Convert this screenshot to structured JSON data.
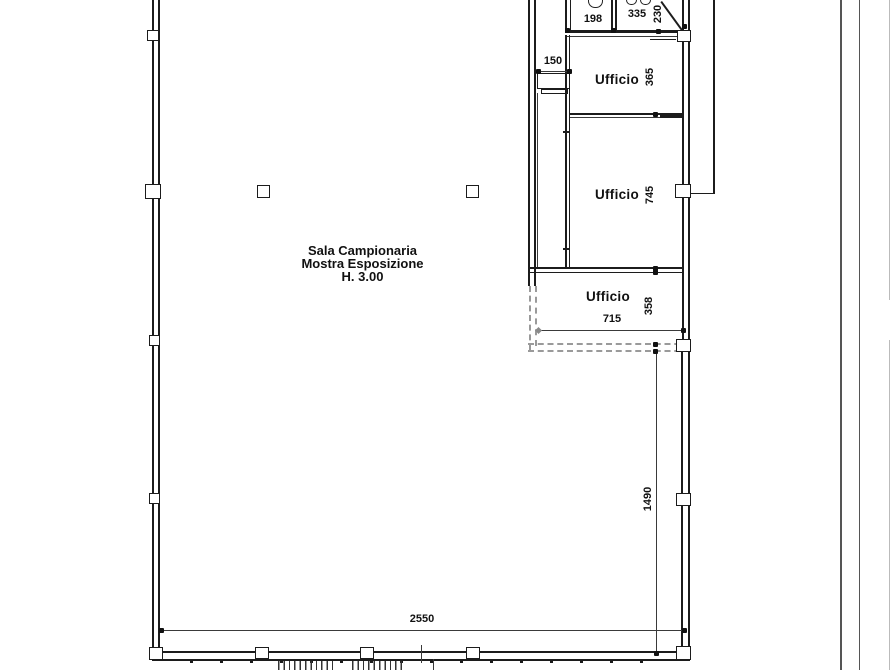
{
  "hall_label": {
    "line1": "Sala Campionaria",
    "line2": "Mostra Esposizione",
    "line3": "H. 3.00"
  },
  "rooms": {
    "ufficio_top": "Ufficio",
    "ufficio_middle": "Ufficio",
    "ufficio_bottom": "Ufficio"
  },
  "dimensions": {
    "top_left_room_width": "198",
    "top_right_room_width": "335",
    "top_right_room_depth": "230",
    "entry_width": "150",
    "office_top_depth": "365",
    "office_middle_depth": "745",
    "office_bottom_depth": "358",
    "office_bottom_width": "715",
    "hall_right_height": "1490",
    "hall_bottom_width": "2550"
  },
  "colors": {
    "line": "#1c1c1c",
    "dashed_wall": "#9a9a9a",
    "boundary": "#555555",
    "faint_edge": "#bbbbbb",
    "background": "#ffffff"
  }
}
